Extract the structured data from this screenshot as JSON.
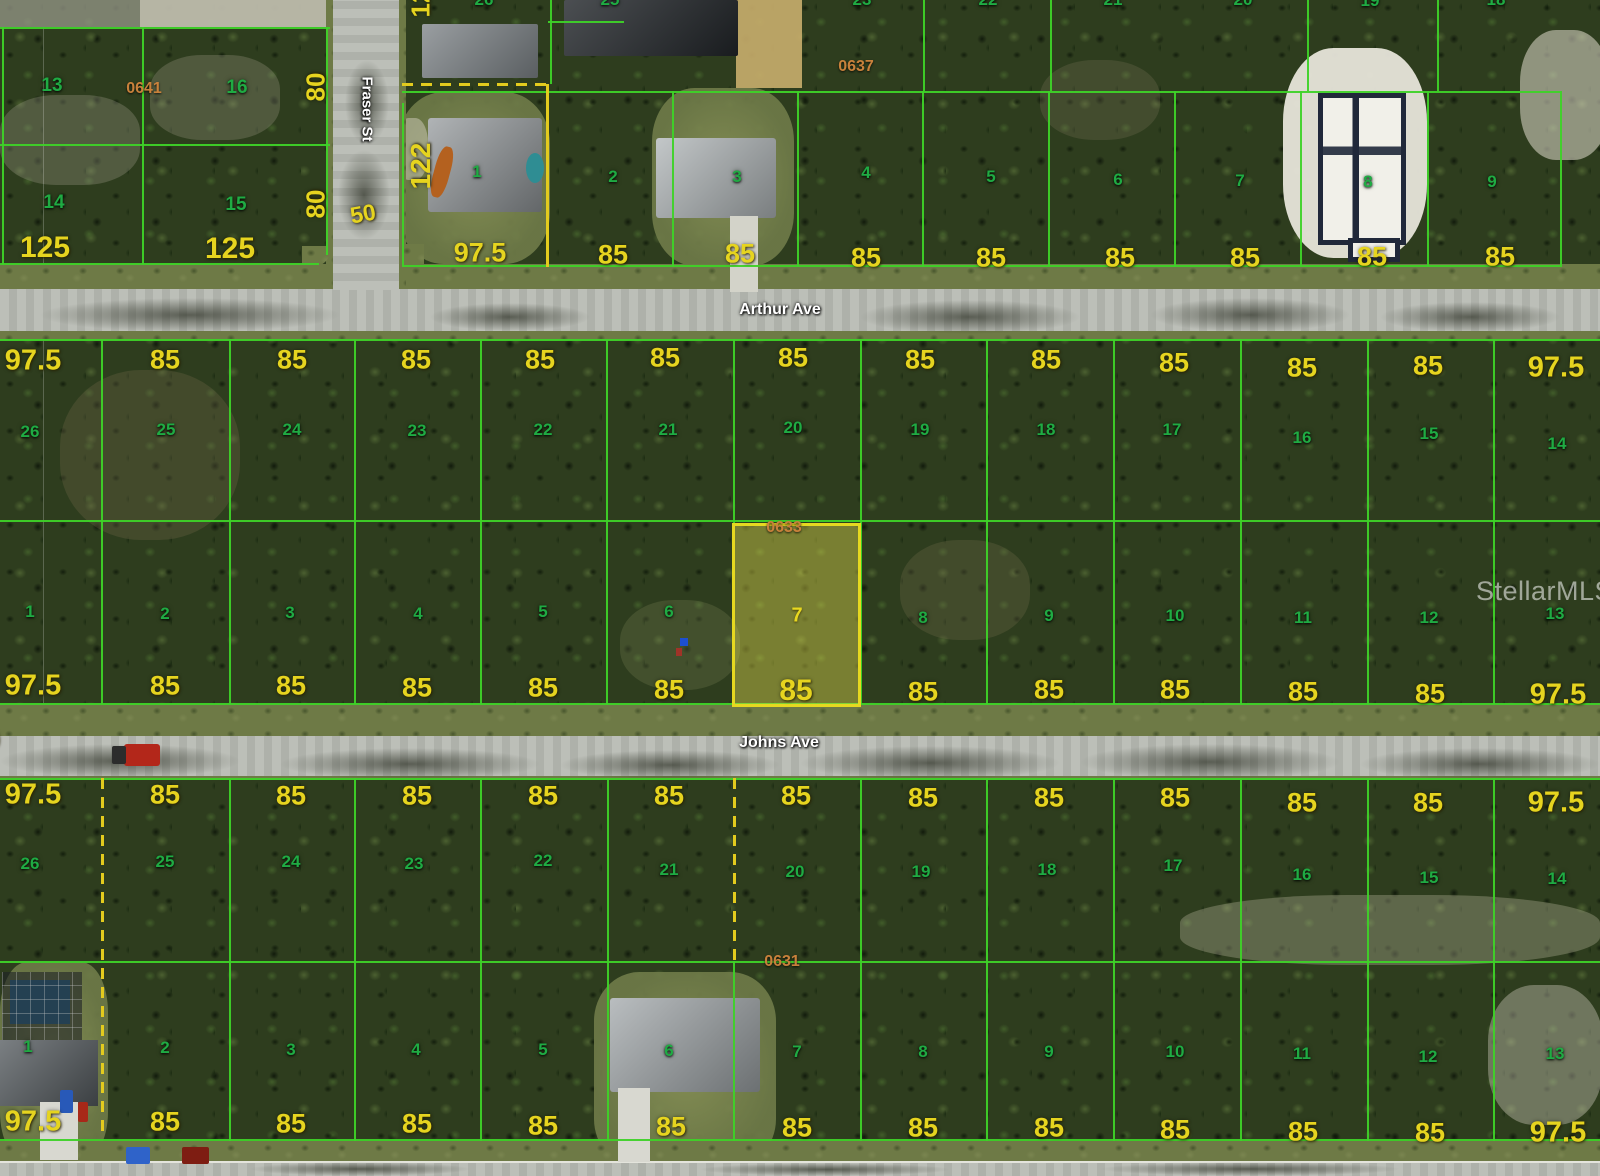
{
  "watermark": {
    "text": "StellarMLS"
  },
  "streets": [
    {
      "name": "Arthur Ave",
      "x": 780,
      "y": 310,
      "orientation": "horizontal"
    },
    {
      "name": "Johns Ave",
      "x": 779,
      "y": 743,
      "orientation": "horizontal"
    },
    {
      "name": "Fraser St",
      "x": 367,
      "y": 109,
      "orientation": "vertical"
    }
  ],
  "block_labels": [
    {
      "t": "0641",
      "x": 144,
      "y": 89
    },
    {
      "t": "0637",
      "x": 856,
      "y": 67
    },
    {
      "t": "0633",
      "x": 784,
      "y": 528
    },
    {
      "t": "0631",
      "x": 782,
      "y": 962
    }
  ],
  "highlight": {
    "lot": "7",
    "block": "0633",
    "frontage": "85",
    "fill": "#ebe450",
    "border": "#e6d820"
  },
  "colors": {
    "parcel_line": "#3ed228",
    "lot_number": "#1fab43",
    "dimension": "#e6d41f",
    "block_number": "#c8813b",
    "dashed_line": "#e3cb1e"
  },
  "lot_labels": [
    {
      "t": "13",
      "x": 52,
      "y": 86,
      "s": 19
    },
    {
      "t": "16",
      "x": 237,
      "y": 88,
      "s": 19
    },
    {
      "t": "14",
      "x": 54,
      "y": 203,
      "s": 19
    },
    {
      "t": "15",
      "x": 236,
      "y": 205,
      "s": 19
    },
    {
      "t": "1",
      "x": 477,
      "y": 172
    },
    {
      "t": "2",
      "x": 613,
      "y": 177
    },
    {
      "t": "3",
      "x": 737,
      "y": 177
    },
    {
      "t": "4",
      "x": 866,
      "y": 173
    },
    {
      "t": "5",
      "x": 991,
      "y": 177
    },
    {
      "t": "6",
      "x": 1118,
      "y": 180
    },
    {
      "t": "7",
      "x": 1240,
      "y": 181
    },
    {
      "t": "8",
      "x": 1368,
      "y": 182
    },
    {
      "t": "9",
      "x": 1492,
      "y": 182
    },
    {
      "t": "26",
      "x": 30,
      "y": 432
    },
    {
      "t": "25",
      "x": 166,
      "y": 430
    },
    {
      "t": "24",
      "x": 292,
      "y": 430
    },
    {
      "t": "23",
      "x": 417,
      "y": 431
    },
    {
      "t": "22",
      "x": 543,
      "y": 430
    },
    {
      "t": "21",
      "x": 668,
      "y": 430
    },
    {
      "t": "20",
      "x": 793,
      "y": 428
    },
    {
      "t": "19",
      "x": 920,
      "y": 430
    },
    {
      "t": "18",
      "x": 1046,
      "y": 430
    },
    {
      "t": "17",
      "x": 1172,
      "y": 430
    },
    {
      "t": "16",
      "x": 1302,
      "y": 438
    },
    {
      "t": "15",
      "x": 1429,
      "y": 434
    },
    {
      "t": "14",
      "x": 1557,
      "y": 444
    },
    {
      "t": "1",
      "x": 30,
      "y": 612
    },
    {
      "t": "2",
      "x": 165,
      "y": 614
    },
    {
      "t": "3",
      "x": 290,
      "y": 613
    },
    {
      "t": "4",
      "x": 418,
      "y": 614
    },
    {
      "t": "5",
      "x": 543,
      "y": 612
    },
    {
      "t": "6",
      "x": 669,
      "y": 612
    },
    {
      "t": "7",
      "x": 797,
      "y": 616,
      "c": "hl"
    },
    {
      "t": "8",
      "x": 923,
      "y": 618
    },
    {
      "t": "9",
      "x": 1049,
      "y": 616
    },
    {
      "t": "10",
      "x": 1175,
      "y": 616
    },
    {
      "t": "11",
      "x": 1303,
      "y": 618
    },
    {
      "t": "12",
      "x": 1429,
      "y": 618
    },
    {
      "t": "13",
      "x": 1555,
      "y": 614
    },
    {
      "t": "26",
      "x": 30,
      "y": 864
    },
    {
      "t": "25",
      "x": 165,
      "y": 862
    },
    {
      "t": "24",
      "x": 291,
      "y": 862
    },
    {
      "t": "23",
      "x": 414,
      "y": 864
    },
    {
      "t": "22",
      "x": 543,
      "y": 861
    },
    {
      "t": "21",
      "x": 669,
      "y": 870
    },
    {
      "t": "20",
      "x": 795,
      "y": 872
    },
    {
      "t": "19",
      "x": 921,
      "y": 872
    },
    {
      "t": "18",
      "x": 1047,
      "y": 870
    },
    {
      "t": "17",
      "x": 1173,
      "y": 866
    },
    {
      "t": "16",
      "x": 1302,
      "y": 875
    },
    {
      "t": "15",
      "x": 1429,
      "y": 878
    },
    {
      "t": "14",
      "x": 1557,
      "y": 879
    },
    {
      "t": "1",
      "x": 28,
      "y": 1047
    },
    {
      "t": "2",
      "x": 165,
      "y": 1048
    },
    {
      "t": "3",
      "x": 291,
      "y": 1050
    },
    {
      "t": "4",
      "x": 416,
      "y": 1050
    },
    {
      "t": "5",
      "x": 543,
      "y": 1050
    },
    {
      "t": "6",
      "x": 669,
      "y": 1051
    },
    {
      "t": "7",
      "x": 797,
      "y": 1052
    },
    {
      "t": "8",
      "x": 923,
      "y": 1052
    },
    {
      "t": "9",
      "x": 1049,
      "y": 1052
    },
    {
      "t": "10",
      "x": 1175,
      "y": 1052
    },
    {
      "t": "11",
      "x": 1302,
      "y": 1054
    },
    {
      "t": "12",
      "x": 1428,
      "y": 1057
    },
    {
      "t": "13",
      "x": 1555,
      "y": 1054
    }
  ],
  "dim_labels": [
    {
      "t": "80",
      "x": 316,
      "y": 87,
      "s": 26,
      "r": -90
    },
    {
      "t": "80",
      "x": 316,
      "y": 204,
      "s": 26,
      "r": -90
    },
    {
      "t": "125",
      "x": 45,
      "y": 248,
      "s": 30
    },
    {
      "t": "125",
      "x": 230,
      "y": 249,
      "s": 30
    },
    {
      "t": "50",
      "x": 363,
      "y": 214,
      "s": 23,
      "r": -10
    },
    {
      "t": "122",
      "x": 421,
      "y": 166,
      "s": 28,
      "r": -90
    },
    {
      "t": "97.5",
      "x": 480,
      "y": 253
    },
    {
      "t": "85",
      "x": 613,
      "y": 255
    },
    {
      "t": "85",
      "x": 740,
      "y": 254
    },
    {
      "t": "85",
      "x": 866,
      "y": 258
    },
    {
      "t": "85",
      "x": 991,
      "y": 258
    },
    {
      "t": "85",
      "x": 1120,
      "y": 258
    },
    {
      "t": "85",
      "x": 1245,
      "y": 258
    },
    {
      "t": "85",
      "x": 1372,
      "y": 257
    },
    {
      "t": "85",
      "x": 1500,
      "y": 257
    },
    {
      "t": "97.5",
      "x": 33,
      "y": 361,
      "s": 29
    },
    {
      "t": "85",
      "x": 165,
      "y": 360
    },
    {
      "t": "85",
      "x": 292,
      "y": 360
    },
    {
      "t": "85",
      "x": 416,
      "y": 360
    },
    {
      "t": "85",
      "x": 540,
      "y": 360
    },
    {
      "t": "85",
      "x": 665,
      "y": 358
    },
    {
      "t": "85",
      "x": 793,
      "y": 358
    },
    {
      "t": "85",
      "x": 920,
      "y": 360
    },
    {
      "t": "85",
      "x": 1046,
      "y": 360
    },
    {
      "t": "85",
      "x": 1174,
      "y": 363
    },
    {
      "t": "85",
      "x": 1302,
      "y": 368
    },
    {
      "t": "85",
      "x": 1428,
      "y": 366
    },
    {
      "t": "97.5",
      "x": 1556,
      "y": 368,
      "s": 29
    },
    {
      "t": "97.5",
      "x": 33,
      "y": 686,
      "s": 29
    },
    {
      "t": "85",
      "x": 165,
      "y": 686
    },
    {
      "t": "85",
      "x": 291,
      "y": 686
    },
    {
      "t": "85",
      "x": 417,
      "y": 688
    },
    {
      "t": "85",
      "x": 543,
      "y": 688
    },
    {
      "t": "85",
      "x": 669,
      "y": 690
    },
    {
      "t": "85",
      "x": 796,
      "y": 691,
      "s": 30
    },
    {
      "t": "85",
      "x": 923,
      "y": 692
    },
    {
      "t": "85",
      "x": 1049,
      "y": 690
    },
    {
      "t": "85",
      "x": 1175,
      "y": 690
    },
    {
      "t": "85",
      "x": 1303,
      "y": 692
    },
    {
      "t": "85",
      "x": 1430,
      "y": 694
    },
    {
      "t": "97.5",
      "x": 1558,
      "y": 695,
      "s": 29
    },
    {
      "t": "97.5",
      "x": 33,
      "y": 795,
      "s": 29
    },
    {
      "t": "85",
      "x": 165,
      "y": 795
    },
    {
      "t": "85",
      "x": 291,
      "y": 796
    },
    {
      "t": "85",
      "x": 417,
      "y": 796
    },
    {
      "t": "85",
      "x": 543,
      "y": 796
    },
    {
      "t": "85",
      "x": 669,
      "y": 796
    },
    {
      "t": "85",
      "x": 796,
      "y": 796
    },
    {
      "t": "85",
      "x": 923,
      "y": 798
    },
    {
      "t": "85",
      "x": 1049,
      "y": 798
    },
    {
      "t": "85",
      "x": 1175,
      "y": 798
    },
    {
      "t": "85",
      "x": 1302,
      "y": 803
    },
    {
      "t": "85",
      "x": 1428,
      "y": 803
    },
    {
      "t": "97.5",
      "x": 1556,
      "y": 803,
      "s": 29
    },
    {
      "t": "97.5",
      "x": 33,
      "y": 1122,
      "s": 29
    },
    {
      "t": "85",
      "x": 165,
      "y": 1122
    },
    {
      "t": "85",
      "x": 291,
      "y": 1124
    },
    {
      "t": "85",
      "x": 417,
      "y": 1124
    },
    {
      "t": "85",
      "x": 543,
      "y": 1126
    },
    {
      "t": "85",
      "x": 671,
      "y": 1127
    },
    {
      "t": "85",
      "x": 797,
      "y": 1128
    },
    {
      "t": "85",
      "x": 923,
      "y": 1128
    },
    {
      "t": "85",
      "x": 1049,
      "y": 1128
    },
    {
      "t": "85",
      "x": 1175,
      "y": 1130
    },
    {
      "t": "85",
      "x": 1303,
      "y": 1132
    },
    {
      "t": "85",
      "x": 1430,
      "y": 1133
    },
    {
      "t": "97.5",
      "x": 1558,
      "y": 1133,
      "s": 29
    }
  ],
  "partial_labels": [
    {
      "t": "26",
      "x": 484,
      "y": 0
    },
    {
      "t": "25",
      "x": 610,
      "y": 0
    },
    {
      "t": "23",
      "x": 862,
      "y": 0
    },
    {
      "t": "22",
      "x": 988,
      "y": 0
    },
    {
      "t": "21",
      "x": 1113,
      "y": 0
    },
    {
      "t": "20",
      "x": 1243,
      "y": 0
    },
    {
      "t": "19",
      "x": 1370,
      "y": 1
    },
    {
      "t": "18",
      "x": 1496,
      "y": 0
    },
    {
      "t": "12",
      "x": 421,
      "y": 3,
      "r": -90,
      "k": "dim",
      "s": 26
    },
    {
      "t": "0",
      "x": -7,
      "y": 741,
      "k": "dim",
      "s": 24
    }
  ]
}
